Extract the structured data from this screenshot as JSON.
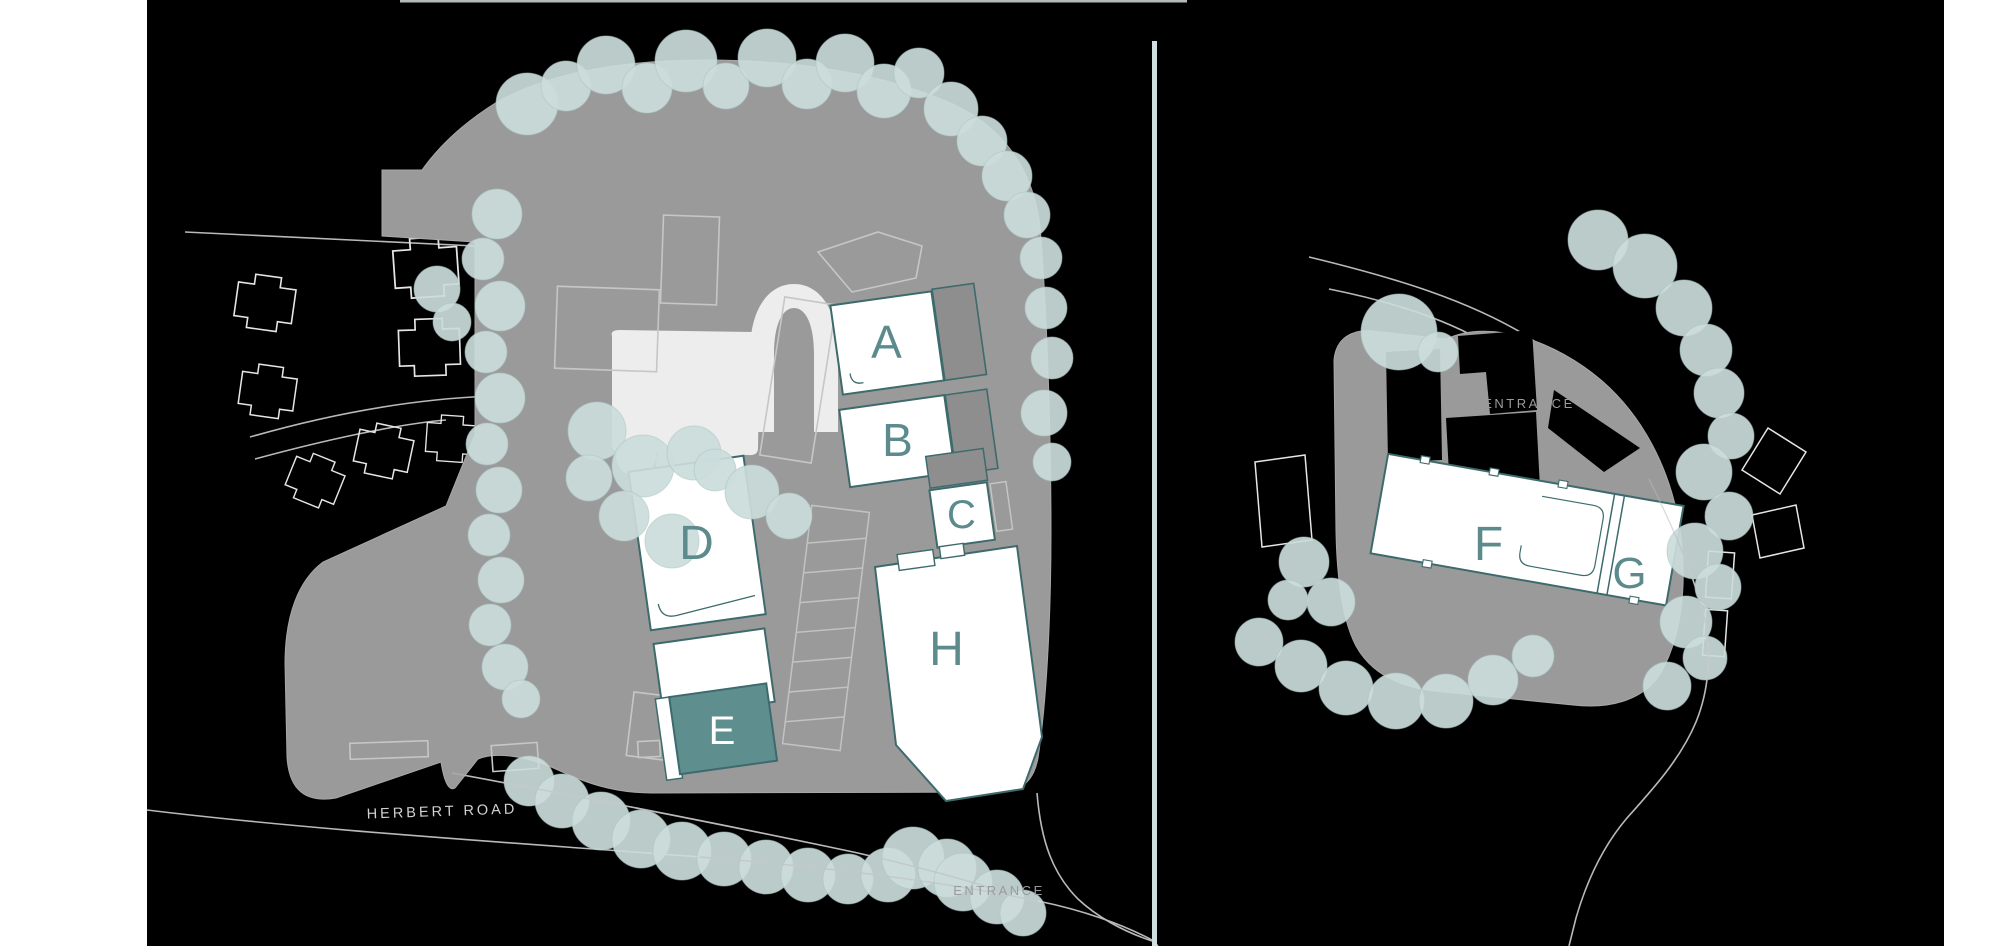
{
  "page": {
    "background_color": "#ffffff"
  },
  "canvas": {
    "background_color": "#000000",
    "top_rule_color": "#b3baba",
    "divider_color": "#cfdfdf"
  },
  "palette": {
    "site_gray": "#9a9a9a",
    "outlined_building_gray": "#c6c6c6",
    "existing_footprint_white": "#ededed",
    "tree_fill": "#cbdcdb",
    "tree_edge": "#a9c4c3",
    "new_building_fill": "#ffffff",
    "new_building_outline": "#3d6a6c",
    "annex_fill": "#8e8e8e",
    "label_teal": "#5d8b8d",
    "highlight_building_fill": "#5f8e8f",
    "road_line": "#b9b9b9",
    "house_outline": "#e6e6e6",
    "road_text": "#d2d2d2",
    "entrance_text": "#9b9b9b"
  },
  "left_plan": {
    "name": "main-site-plan",
    "road_label": "HERBERT ROAD",
    "entrance_label": "ENTRANCE",
    "buildings": [
      {
        "label": "A",
        "highlighted": false
      },
      {
        "label": "B",
        "highlighted": false
      },
      {
        "label": "C",
        "highlighted": false
      },
      {
        "label": "D",
        "highlighted": false
      },
      {
        "label": "E",
        "highlighted": true
      },
      {
        "label": "H",
        "highlighted": false
      }
    ]
  },
  "right_plan": {
    "name": "secondary-site-plan",
    "entrance_label": "ENTRANCE",
    "buildings": [
      {
        "label": "F",
        "highlighted": false
      },
      {
        "label": "G",
        "highlighted": false
      }
    ]
  }
}
